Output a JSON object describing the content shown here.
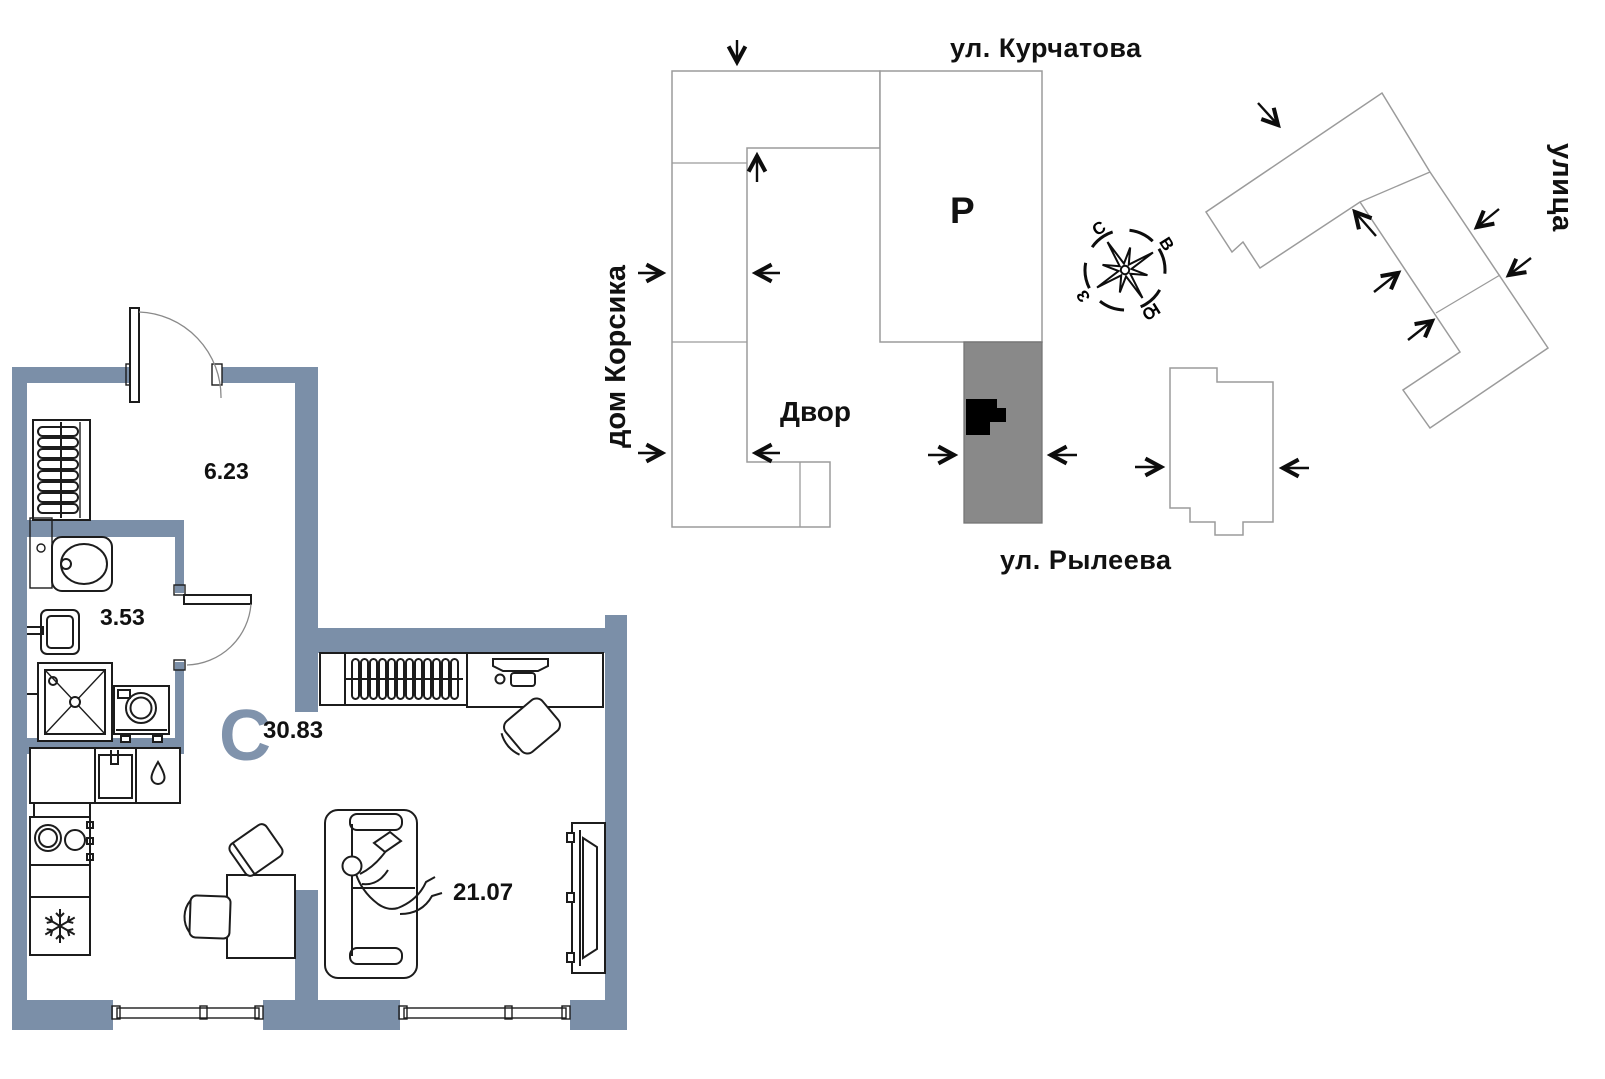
{
  "site_plan": {
    "street_top_label": "ул. Курчатова",
    "street_bottom_label": "ул. Рылеева",
    "street_right_label": "улица",
    "neighbor_building_label": "дом Корсика",
    "courtyard_label": "Двор",
    "parking_label": "Р",
    "compass": {
      "north": "С",
      "east": "В",
      "south": "Ю",
      "west": "З"
    }
  },
  "floor_plan": {
    "type_letter": "С",
    "total_area": "30.83",
    "hallway_area": "6.23",
    "bathroom_area": "3.53",
    "living_area": "21.07"
  },
  "colors": {
    "wall": "#7b8fa8",
    "accent": "#8093ac",
    "ink": "#1c1c1c",
    "outline": "#9b9b9b",
    "graybld": "#898989"
  }
}
